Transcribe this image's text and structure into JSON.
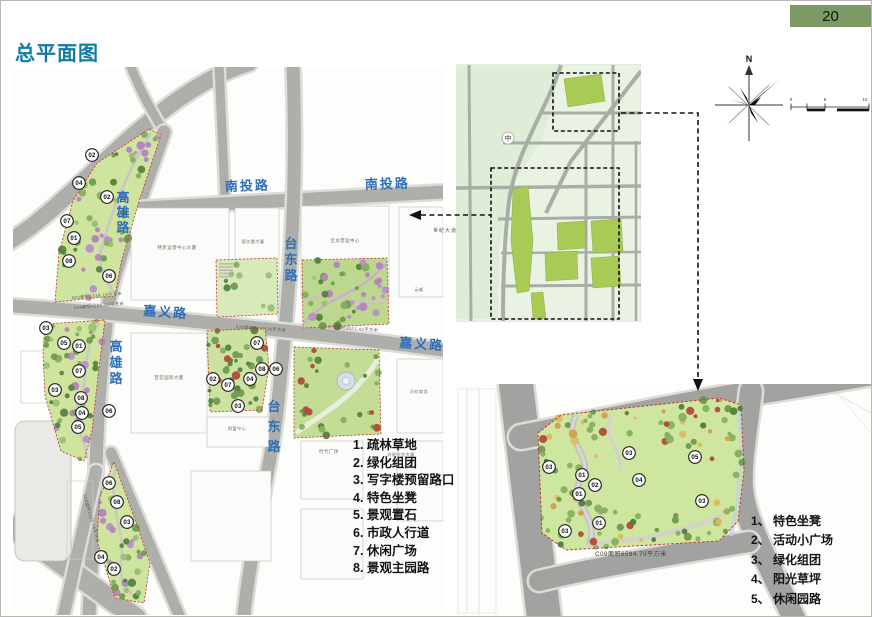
{
  "page": {
    "number": "20",
    "title": "总平面图"
  },
  "colors": {
    "header_green": "#7c9a63",
    "title_teal": "#0f7ba6",
    "road_label_blue": "#2e6fb7",
    "park_green": "#cfe49f",
    "boundary_red": "#c3392f",
    "overview_park_green": "#a9cb56",
    "road_gray": "#aeaeab"
  },
  "main_map": {
    "road_labels": [
      {
        "text": "南投路",
        "x": 224,
        "y": 190,
        "rot": -2
      },
      {
        "text": "南投路",
        "x": 364,
        "y": 188,
        "rot": -2
      },
      {
        "text": "高雄路",
        "x": 122,
        "y": 201,
        "vertical": true,
        "dy": 15
      },
      {
        "text": "高雄路",
        "x": 115,
        "y": 350,
        "vertical": true,
        "dy": 16
      },
      {
        "text": "台东路",
        "x": 290,
        "y": 247,
        "vertical": true,
        "dy": 16
      },
      {
        "text": "台东路",
        "x": 273,
        "y": 410,
        "vertical": true,
        "dy": 20
      },
      {
        "text": "嘉义路",
        "x": 142,
        "y": 314,
        "rot": 4
      },
      {
        "text": "嘉义路",
        "x": 398,
        "y": 346,
        "rot": 4
      }
    ],
    "building_labels": [
      {
        "text": "特步运营中心大厦",
        "x": 176,
        "y": 248,
        "s": 4.5
      },
      {
        "text": "德尔惠大厦",
        "x": 252,
        "y": 242,
        "s": 4.2
      },
      {
        "text": "宝龙营运中心",
        "x": 344,
        "y": 241,
        "s": 4.5
      },
      {
        "text": "百宏国际大厦",
        "x": 168,
        "y": 378,
        "s": 4.5
      },
      {
        "text": "财富中心",
        "x": 236,
        "y": 429,
        "s": 4.2
      },
      {
        "text": "时代广场",
        "x": 328,
        "y": 452,
        "s": 4.5
      },
      {
        "text": "天虹商务",
        "x": 418,
        "y": 392,
        "s": 4.2
      },
      {
        "text": "云威",
        "x": 418,
        "y": 290,
        "s": 4
      },
      {
        "text": "鸿星尔克大厦",
        "x": 400,
        "y": 455,
        "s": 4.2
      }
    ],
    "area_annotations": [
      {
        "text": "023面积1338.16平方米",
        "x": 96,
        "y": 296,
        "rot": -5
      },
      {
        "text": "024面积4265.68平方米",
        "x": 98,
        "y": 306,
        "rot": -5
      },
      {
        "text": "026面积2318.36平方米",
        "x": 260,
        "y": 329,
        "rot": 4
      },
      {
        "text": "027面积3621.42平方米",
        "x": 352,
        "y": 329,
        "rot": 4
      },
      {
        "text": "025面积1126.74平方米",
        "x": 89,
        "y": 518,
        "rot": 74
      }
    ],
    "markers": [
      {
        "n": "02",
        "x": 91,
        "y": 154
      },
      {
        "n": "04",
        "x": 78,
        "y": 182
      },
      {
        "n": "02",
        "x": 106,
        "y": 196
      },
      {
        "n": "07",
        "x": 66,
        "y": 220
      },
      {
        "n": "01",
        "x": 73,
        "y": 237
      },
      {
        "n": "08",
        "x": 68,
        "y": 260
      },
      {
        "n": "06",
        "x": 108,
        "y": 275
      },
      {
        "n": "03",
        "x": 45,
        "y": 327
      },
      {
        "n": "05",
        "x": 63,
        "y": 342
      },
      {
        "n": "01",
        "x": 78,
        "y": 345
      },
      {
        "n": "07",
        "x": 78,
        "y": 370
      },
      {
        "n": "03",
        "x": 54,
        "y": 389
      },
      {
        "n": "08",
        "x": 80,
        "y": 397
      },
      {
        "n": "04",
        "x": 81,
        "y": 412
      },
      {
        "n": "05",
        "x": 77,
        "y": 426
      },
      {
        "n": "06",
        "x": 108,
        "y": 410
      },
      {
        "n": "07",
        "x": 256,
        "y": 342
      },
      {
        "n": "08",
        "x": 261,
        "y": 368
      },
      {
        "n": "06",
        "x": 275,
        "y": 368
      },
      {
        "n": "02",
        "x": 212,
        "y": 378
      },
      {
        "n": "04",
        "x": 249,
        "y": 378
      },
      {
        "n": "07",
        "x": 227,
        "y": 384
      },
      {
        "n": "03",
        "x": 237,
        "y": 405
      },
      {
        "n": "06",
        "x": 108,
        "y": 482
      },
      {
        "n": "08",
        "x": 116,
        "y": 501
      },
      {
        "n": "03",
        "x": 126,
        "y": 521
      },
      {
        "n": "04",
        "x": 100,
        "y": 556
      },
      {
        "n": "02",
        "x": 113,
        "y": 568
      }
    ]
  },
  "overview_map": {
    "center_label": "中"
  },
  "connectors": {
    "street_label": "世纪大道"
  },
  "compass": {
    "label": "N"
  },
  "scale_bar": {
    "ticks": [
      "0",
      "5",
      "10"
    ]
  },
  "main_legend": {
    "items": [
      "1. 疏林草地",
      "2. 绿化组团",
      "3. 写字楼预留路口",
      "4. 特色坐凳",
      "5. 景观置石",
      "6. 市政人行道",
      "7. 休闲广场",
      "8. 景观主园路"
    ]
  },
  "detail_map": {
    "caption": "C09面积6594.70平方米",
    "markers": [
      {
        "n": "03",
        "x": 548,
        "y": 466
      },
      {
        "n": "01",
        "x": 581,
        "y": 474
      },
      {
        "n": "02",
        "x": 594,
        "y": 484
      },
      {
        "n": "01",
        "x": 578,
        "y": 493
      },
      {
        "n": "01",
        "x": 598,
        "y": 522
      },
      {
        "n": "03",
        "x": 564,
        "y": 530
      },
      {
        "n": "03",
        "x": 628,
        "y": 452
      },
      {
        "n": "04",
        "x": 638,
        "y": 479
      },
      {
        "n": "05",
        "x": 694,
        "y": 456
      },
      {
        "n": "03",
        "x": 701,
        "y": 500
      }
    ],
    "legend": {
      "items": [
        "1、 特色坐凳",
        "2、 活动小广场",
        "3、 绿化组团",
        "4、 阳光草坪",
        "5、 休闲园路"
      ]
    }
  }
}
